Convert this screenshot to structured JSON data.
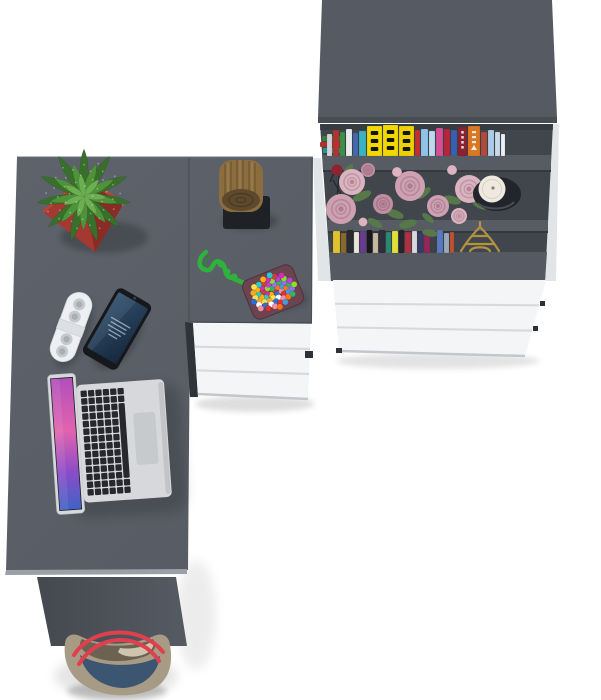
{
  "scene": {
    "title": "Top-down 3D product render: L-shaped grey desk with bookcase, drawers and accessories",
    "background": "#ffffff",
    "items": [
      "cactus in red square pot",
      "wooden log decor on black mat",
      "green rope with multicolor beaded pad",
      "white remote control",
      "smartphone",
      "open silver laptop",
      "bookcase with books, roses, candle and Eiffel tower figurine",
      "white three-drawer units",
      "handbag with red straps"
    ]
  },
  "colors": {
    "bg": "#ffffff",
    "desk_top": "#575c64",
    "desk_top_light": "#5e636b",
    "desk_edge": "#9aa0a7",
    "desk_front": "#555b63",
    "desk_front_dark": "#44494f",
    "seam": "#464b52",
    "bookcase_top": "#565b63",
    "bookcase_top_edge": "#484d54",
    "bookcase_interior": "#41464d",
    "shelf_board": "#575c64",
    "board_shadow": "#33383e",
    "bookcase_side": "#e2e5e8",
    "bookcase_base": "#545962",
    "drawer_white": "#f4f5f7",
    "drawer_gap": "#d7dadd",
    "drawer_edge": "#c3c7cb",
    "drawer_dark_strip": "#2f343a",
    "pot_left": "#a43931",
    "pot_right": "#8a2c26",
    "pot_rim": "#b4453b",
    "leaf_dark": "#38702b",
    "leaf_mid": "#4f9339",
    "leaf_light": "#6cae52",
    "log_bark": "#8b6d40",
    "log_bark_dark": "#6c5330",
    "log_bark_light": "#a68953",
    "log_face": "#5e492c",
    "log_ring": "#4a3820",
    "mat_black": "#1e2126",
    "rope": "#2fb23c",
    "rope_dark": "#1f8f2c",
    "bead_base": "#6b4450",
    "remote_body": "#edeff2",
    "remote_button": "#c5c9ce",
    "remote_button_dark": "#a9aeb4",
    "remote_band": "#dcdfe3",
    "phone_body": "#16181c",
    "phone_screen_a": "#31506e",
    "phone_screen_b": "#16283c",
    "laptop_silver": "#d6d8db",
    "laptop_silver_dark": "#b4b7bb",
    "key": "#26282d",
    "trackpad": "#c7cacd",
    "wall_a": "#b04fba",
    "wall_b": "#e263ae",
    "wall_c": "#8a4cc8",
    "wall_d": "#3f63c6",
    "candle_holder": "#22252b",
    "candle_wax": "#efeadf",
    "eiffel": "#b2913f",
    "rose_pale": "#dcb3c0",
    "rose_mid": "#cfa0b2",
    "rose_deep": "#c08da3",
    "rose_red": "#8e2430",
    "leaf_green": "#57794a",
    "bag_taupe": "#a89b85",
    "bag_navy": "#3c5570",
    "bag_inner_dark": "#6b6252",
    "bag_inner_light": "#cfc5ae",
    "bag_strap": "#e0404e"
  },
  "bookcase": {
    "stack_books": [
      {
        "x": 322,
        "y": 136,
        "w": 20,
        "h": 5,
        "c": "#3f7a35"
      },
      {
        "x": 320,
        "y": 142,
        "w": 23,
        "h": 5,
        "c": "#b03030"
      },
      {
        "x": 323,
        "y": 148,
        "w": 20,
        "h": 5,
        "c": "#2f8f8f"
      }
    ],
    "top_shelf_books": [
      {
        "w": 5,
        "h": 22,
        "c": "#cfd3d6"
      },
      {
        "w": 6,
        "h": 26,
        "c": "#b23432"
      },
      {
        "w": 5,
        "h": 24,
        "c": "#3d8f46"
      },
      {
        "w": 6,
        "h": 27,
        "c": "#e9ebed"
      },
      {
        "w": 5,
        "h": 23,
        "c": "#4668b2"
      },
      {
        "w": 7,
        "h": 25,
        "c": "#39b3c4"
      },
      {
        "w": 15,
        "h": 30,
        "c": "#f2d800",
        "m": 1
      },
      {
        "w": 15,
        "h": 31,
        "c": "#f2d800",
        "m": 1
      },
      {
        "w": 15,
        "h": 30,
        "c": "#edd000",
        "m": 1
      },
      {
        "w": 5,
        "h": 26,
        "c": "#c23030"
      },
      {
        "w": 7,
        "h": 27,
        "c": "#8fc3e8"
      },
      {
        "w": 6,
        "h": 25,
        "c": "#bcd9f0"
      },
      {
        "w": 7,
        "h": 28,
        "c": "#d44f96"
      },
      {
        "w": 6,
        "h": 27,
        "c": "#b2283a"
      },
      {
        "w": 6,
        "h": 26,
        "c": "#3a5fb0"
      },
      {
        "w": 9,
        "h": 29,
        "c": "#8a2230",
        "m": 2
      },
      {
        "w": 12,
        "h": 30,
        "c": "#d97822",
        "m": 3
      },
      {
        "w": 6,
        "h": 24,
        "c": "#b24a3a"
      },
      {
        "w": 6,
        "h": 26,
        "c": "#a9cde9"
      },
      {
        "w": 5,
        "h": 24,
        "c": "#c9d9e9"
      },
      {
        "w": 4,
        "h": 22,
        "c": "#e9eff3"
      }
    ],
    "bottom_shelf_books": [
      {
        "w": 7,
        "h": 22,
        "c": "#e0c22e"
      },
      {
        "w": 5,
        "h": 20,
        "c": "#8a6a2a"
      },
      {
        "w": 6,
        "h": 23,
        "c": "#2a2a30"
      },
      {
        "w": 5,
        "h": 21,
        "c": "#e8e4da"
      },
      {
        "w": 6,
        "h": 22,
        "c": "#6a3a8f"
      },
      {
        "w": 5,
        "h": 23,
        "c": "#1a1a1e"
      },
      {
        "w": 5,
        "h": 20,
        "c": "#cab8a0"
      },
      {
        "w": 6,
        "h": 23,
        "c": "#30303a"
      },
      {
        "w": 5,
        "h": 21,
        "c": "#2a8a70"
      },
      {
        "w": 6,
        "h": 22,
        "c": "#e3de3a"
      },
      {
        "w": 5,
        "h": 23,
        "c": "#26262c"
      },
      {
        "w": 6,
        "h": 21,
        "c": "#b03040"
      },
      {
        "w": 5,
        "h": 22,
        "c": "#d8d8dc"
      },
      {
        "w": 5,
        "h": 20,
        "c": "#3a3a6a"
      },
      {
        "w": 6,
        "h": 22,
        "c": "#902858"
      },
      {
        "w": 5,
        "h": 21,
        "c": "#404048"
      },
      {
        "w": 6,
        "h": 23,
        "c": "#5a78c0"
      },
      {
        "w": 5,
        "h": 20,
        "c": "#98a8b8"
      },
      {
        "w": 4,
        "h": 21,
        "c": "#c05030"
      }
    ],
    "roses": [
      {
        "x": 352,
        "y": 182,
        "r": 13,
        "k": "rose_pale"
      },
      {
        "x": 410,
        "y": 186,
        "r": 15,
        "k": "rose_mid"
      },
      {
        "x": 469,
        "y": 189,
        "r": 14,
        "k": "rose_pale"
      },
      {
        "x": 341,
        "y": 209,
        "r": 15,
        "k": "rose_mid"
      },
      {
        "x": 383,
        "y": 204,
        "r": 10,
        "k": "rose_deep"
      },
      {
        "x": 438,
        "y": 206,
        "r": 11,
        "k": "rose_mid"
      },
      {
        "x": 459,
        "y": 216,
        "r": 8,
        "k": "rose_pale"
      },
      {
        "x": 368,
        "y": 170,
        "r": 7,
        "k": "rose_deep"
      }
    ],
    "buds": [
      {
        "x": 397,
        "y": 172,
        "r": 5
      },
      {
        "x": 452,
        "y": 170,
        "r": 5
      },
      {
        "x": 363,
        "y": 222,
        "r": 4.5
      }
    ],
    "leaves": [
      {
        "x": 362,
        "y": 196,
        "rx": 10,
        "ry": 4,
        "a": -25
      },
      {
        "x": 395,
        "y": 214,
        "rx": 9,
        "ry": 4,
        "a": 20
      },
      {
        "x": 424,
        "y": 193,
        "rx": 8,
        "ry": 3.5,
        "a": -40
      },
      {
        "x": 452,
        "y": 200,
        "rx": 9,
        "ry": 4,
        "a": 15
      },
      {
        "x": 375,
        "y": 223,
        "rx": 8,
        "ry": 3.5,
        "a": 30
      },
      {
        "x": 408,
        "y": 224,
        "rx": 9,
        "ry": 4,
        "a": -15
      },
      {
        "x": 428,
        "y": 218,
        "rx": 7,
        "ry": 3,
        "a": 40
      },
      {
        "x": 348,
        "y": 170,
        "rx": 7,
        "ry": 3,
        "a": -50
      },
      {
        "x": 480,
        "y": 205,
        "rx": 8,
        "ry": 3.5,
        "a": 25
      },
      {
        "x": 430,
        "y": 233,
        "rx": 8,
        "ry": 3.5,
        "a": 10
      }
    ]
  },
  "cactus": {
    "cx": 84,
    "cy": 196,
    "rings": [
      {
        "n": 11,
        "len": 47,
        "w": 14,
        "c": "leaf_dark"
      },
      {
        "n": 9,
        "len": 34,
        "w": 12,
        "c": "leaf_mid"
      },
      {
        "n": 7,
        "len": 22,
        "w": 10,
        "c": "leaf_light"
      }
    ]
  },
  "beads": {
    "palette": [
      "#e03030",
      "#ffb300",
      "#2db56a",
      "#2d6fd6",
      "#d32db5",
      "#ff7322",
      "#ffe14d",
      "#8ae02d",
      "#f090a0",
      "#2dc8c8",
      "#9a6cf0",
      "#ffffff",
      "#c84040",
      "#4a9ad6",
      "#f0a830",
      "#c33dd6"
    ]
  }
}
